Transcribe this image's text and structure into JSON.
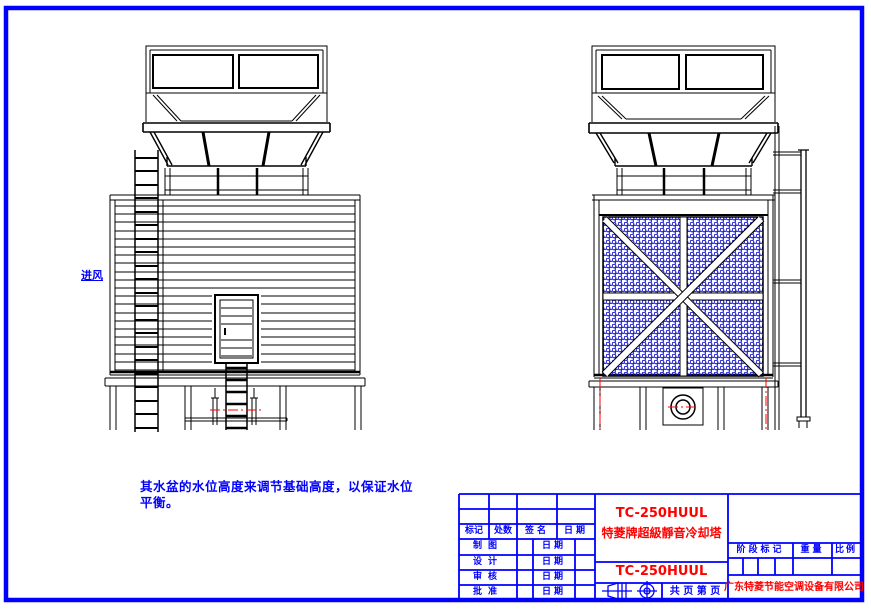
{
  "colors": {
    "background": "#ffffff",
    "border_blue": "#0000ff",
    "line_black": "#000000",
    "accent_red": "#ff0000",
    "mesh_blue": "#1a1acc"
  },
  "annotations": {
    "air_inlet_label": "进风",
    "note_line1": "其水盆的水位高度来调节基础高度，以保证水位",
    "note_line2": "平衡。"
  },
  "title_block": {
    "product_model": "TC-250HUUL",
    "product_name": "特菱牌超級靜音冷却塔",
    "model_repeat": "TC-250HUUL",
    "company": "广东特菱节能空调设备有限公司",
    "pages_label": "共 页 第 页",
    "left_table": {
      "headers": [
        "标记",
        "处数",
        "签名",
        "日期"
      ],
      "rows": [
        {
          "label": "制图",
          "date": "日期"
        },
        {
          "label": "设计",
          "date": "日期"
        },
        {
          "label": "审核",
          "date": "日期"
        },
        {
          "label": "批准",
          "date": "日期"
        }
      ]
    },
    "right_table": {
      "headers": [
        "阶段标记",
        "重量",
        "比例"
      ]
    },
    "icons": {
      "projection": "first-angle-projection-icon",
      "target": "crosshair-target-icon"
    }
  }
}
